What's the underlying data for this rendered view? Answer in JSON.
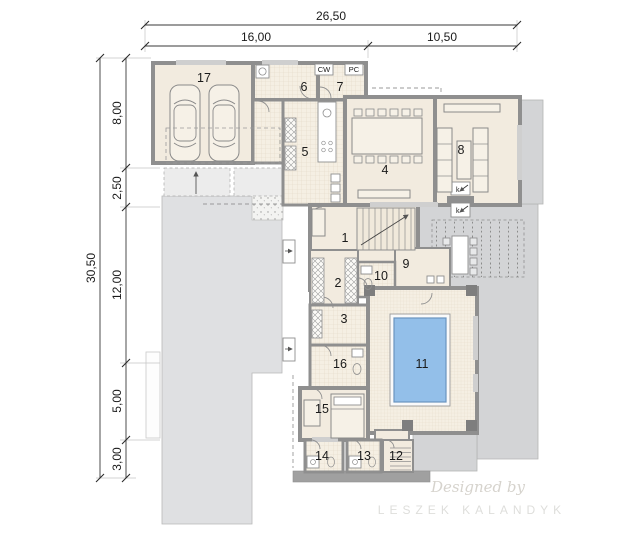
{
  "plan": {
    "dimensions": {
      "top": {
        "total": "26,50",
        "segments": [
          "16,00",
          "10,50"
        ]
      },
      "left": {
        "total": "30,50",
        "segments": [
          "8,00",
          "2,50",
          "12,00",
          "5,00",
          "3,00"
        ]
      }
    },
    "rooms": {
      "r1": "1",
      "r2": "2",
      "r3": "3",
      "r4": "4",
      "r5": "5",
      "r6": "6",
      "r7": "7",
      "r8": "8",
      "r9": "9",
      "r10": "10",
      "r11": "11",
      "r12": "12",
      "r13": "13",
      "r14": "14",
      "r15": "15",
      "r16": "16",
      "r17": "17"
    },
    "annotations": {
      "cw": "CW",
      "pc": "PC",
      "k_upper": "k",
      "k_lower": "k"
    },
    "watermark": {
      "line1": "Designed by",
      "line2": "LESZEK KALANDYK"
    },
    "colors": {
      "wall": "#8f8f8f",
      "floor": "#f2ebdf",
      "tile_grid": "#e3d8c5",
      "terrace": "#d3d4d6",
      "driveway": "#dfe0e2",
      "pool_water": "#93bfe9",
      "pool_edge": "#6a94bf",
      "dimension_text": "#1a1a1a",
      "watermark": "#dcd9d4"
    }
  }
}
